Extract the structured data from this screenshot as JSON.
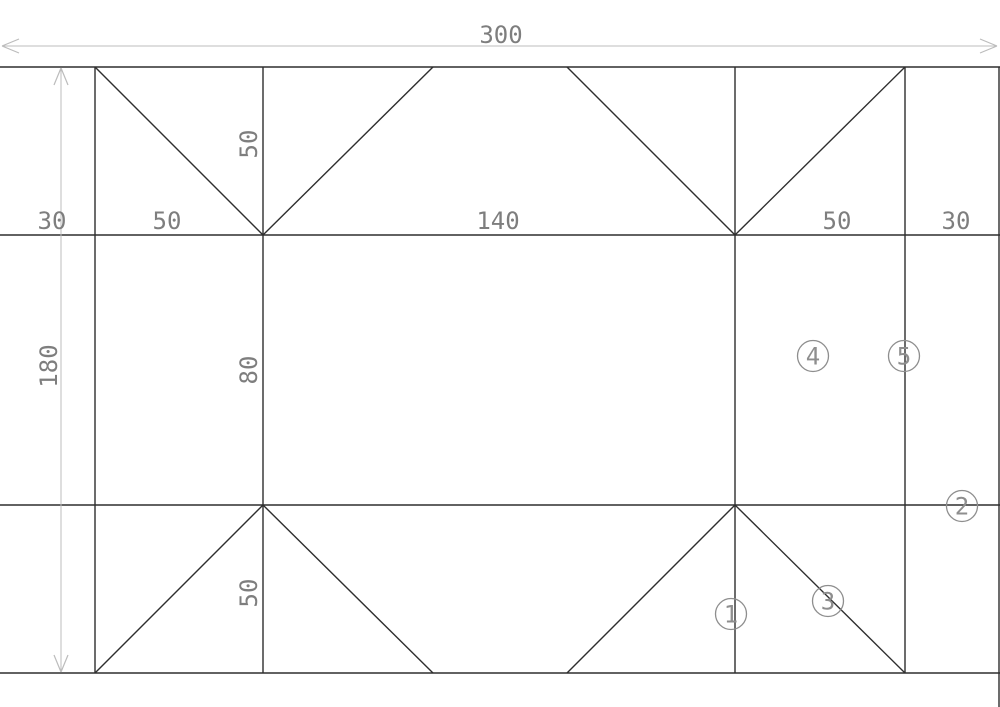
{
  "drawing": {
    "canvas": {
      "width": 1000,
      "height": 707,
      "background": "#ffffff"
    },
    "colors": {
      "geometry": "#2e2e2e",
      "dimension_line": "#bcbcbc",
      "dimension_text": "#7e7e7e",
      "balloon": "#8e8e8e"
    },
    "geometry_lines": [
      [
        0,
        67,
        1000,
        67
      ],
      [
        0,
        235,
        1000,
        235
      ],
      [
        0,
        505,
        1000,
        505
      ],
      [
        0,
        673,
        1000,
        673
      ],
      [
        95,
        67,
        95,
        673
      ],
      [
        263,
        67,
        263,
        673
      ],
      [
        735,
        67,
        735,
        673
      ],
      [
        905,
        67,
        905,
        673
      ],
      [
        999,
        67,
        999,
        707
      ],
      [
        95,
        67,
        263,
        235
      ],
      [
        263,
        235,
        433,
        67
      ],
      [
        567,
        67,
        735,
        235
      ],
      [
        735,
        235,
        905,
        67
      ],
      [
        95,
        673,
        263,
        505
      ],
      [
        263,
        505,
        433,
        673
      ],
      [
        567,
        673,
        735,
        505
      ],
      [
        735,
        505,
        905,
        673
      ]
    ],
    "dimension_lines": [
      {
        "x1": 2,
        "y1": 46,
        "x2": 997,
        "y2": 46,
        "orientation": "horizontal",
        "label": "300"
      },
      {
        "x1": 61,
        "y1": 68,
        "x2": 61,
        "y2": 672,
        "orientation": "vertical",
        "label": "180"
      }
    ],
    "labels": [
      {
        "text": "300",
        "x": 501,
        "y": 43,
        "rotate": 0
      },
      {
        "text": "30",
        "x": 52,
        "y": 229,
        "rotate": 0
      },
      {
        "text": "50",
        "x": 167,
        "y": 229,
        "rotate": 0
      },
      {
        "text": "140",
        "x": 498,
        "y": 229,
        "rotate": 0
      },
      {
        "text": "50",
        "x": 837,
        "y": 229,
        "rotate": 0
      },
      {
        "text": "30",
        "x": 956,
        "y": 229,
        "rotate": 0
      },
      {
        "text": "180",
        "x": 57,
        "y": 366,
        "rotate": -90
      },
      {
        "text": "50",
        "x": 257,
        "y": 144,
        "rotate": -90
      },
      {
        "text": "80",
        "x": 257,
        "y": 370,
        "rotate": -90
      },
      {
        "text": "50",
        "x": 257,
        "y": 593,
        "rotate": -90
      }
    ],
    "balloons": [
      {
        "text": "1",
        "cx": 731,
        "cy": 614,
        "r": 15.5
      },
      {
        "text": "2",
        "cx": 962,
        "cy": 506,
        "r": 15.5
      },
      {
        "text": "3",
        "cx": 828,
        "cy": 601,
        "r": 15.5
      },
      {
        "text": "4",
        "cx": 813,
        "cy": 356,
        "r": 15.5
      },
      {
        "text": "5",
        "cx": 904,
        "cy": 356,
        "r": 15.5
      }
    ]
  }
}
